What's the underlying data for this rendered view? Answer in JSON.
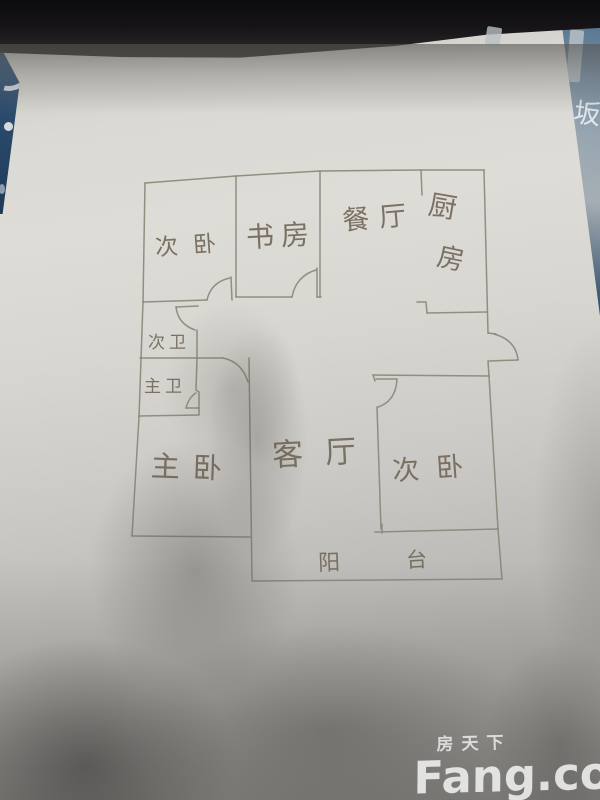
{
  "image_type": "photo of a hand-drawn apartment floor plan on a blue desk",
  "watermark": {
    "site_cn": "房天下",
    "site_en": "Fang.com"
  },
  "background_text": {
    "right_edge_char": "坂"
  },
  "colors": {
    "paper": "#dcdad5",
    "pencil": "#8a8375",
    "desk_blue": "#2b4a6b",
    "shelf_black": "#161417",
    "watermark_white": "#fdfdfd"
  },
  "floorplan": {
    "rooms": [
      {
        "key": "bedroom-top-left",
        "label": "次卧"
      },
      {
        "key": "study",
        "label": "书房"
      },
      {
        "key": "dining",
        "label": "餐厅"
      },
      {
        "key": "kitchen",
        "label": "厨房",
        "chars": [
          "厨",
          "房"
        ]
      },
      {
        "key": "bath-second",
        "label": "次卫"
      },
      {
        "key": "bath-master",
        "label": "主卫"
      },
      {
        "key": "bedroom-master",
        "label": "主卧"
      },
      {
        "key": "living",
        "label": "客厅"
      },
      {
        "key": "bedroom-right",
        "label": "次卧"
      },
      {
        "key": "balcony",
        "label": "阳台",
        "chars": [
          "阳",
          "台"
        ]
      }
    ]
  }
}
